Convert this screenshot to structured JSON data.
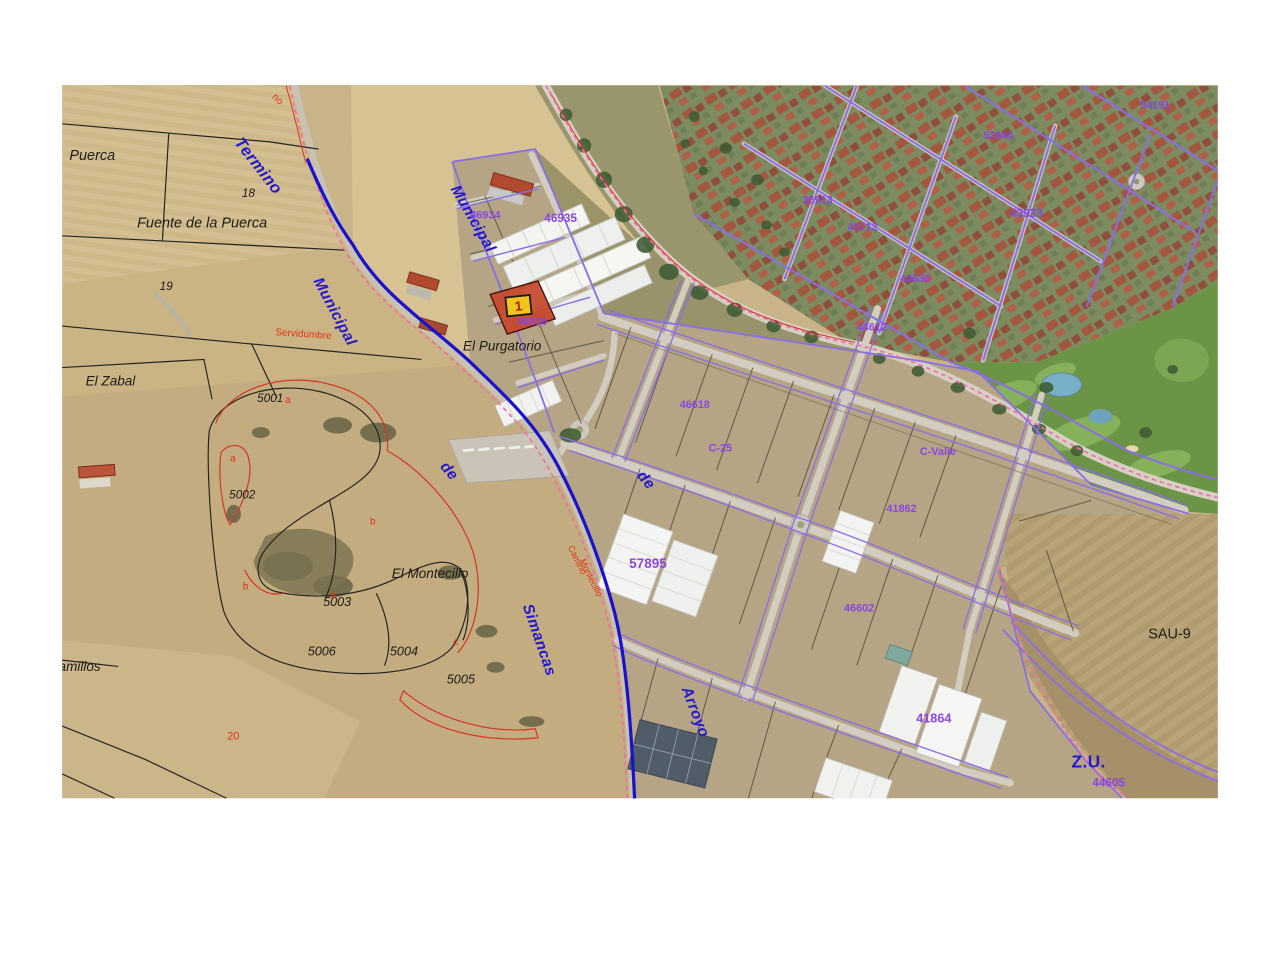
{
  "map_type": "aerial-cadastral-viewer",
  "marker": {
    "label": "1"
  },
  "colors": {
    "municipal_boundary_line": "#1d12cc",
    "cadastral_parcel_line": "#8a6ee6",
    "limit_dashed_line": "#ef6fa0",
    "highlighted_parcel_fill": "#c7462b",
    "marker_background": "#f2c51c",
    "label_black": "#1d1b16",
    "label_blue": "#2317d0",
    "label_red": "#e23318",
    "label_purple": "#8a46e0"
  },
  "labels": [
    {
      "t": "Puerca",
      "c": "black",
      "x": 8,
      "y": 168,
      "r": 0,
      "s": 16,
      "i": 1
    },
    {
      "t": "Fuente de la Puerca",
      "c": "black",
      "x": 83,
      "y": 243,
      "r": 0,
      "s": 16,
      "i": 1
    },
    {
      "t": "18",
      "c": "black",
      "x": 199,
      "y": 209,
      "r": 0,
      "s": 13,
      "i": 1
    },
    {
      "t": "19",
      "c": "black",
      "x": 108,
      "y": 312,
      "r": 0,
      "s": 13,
      "i": 1
    },
    {
      "t": "El Zabal",
      "c": "black",
      "x": 26,
      "y": 418,
      "r": 0,
      "s": 15,
      "i": 1
    },
    {
      "t": "5001",
      "c": "black",
      "x": 216,
      "y": 436,
      "r": 0,
      "s": 13,
      "i": 1
    },
    {
      "t": "5002",
      "c": "black",
      "x": 185,
      "y": 543,
      "r": 0,
      "s": 13,
      "i": 1
    },
    {
      "t": "5003",
      "c": "black",
      "x": 289,
      "y": 662,
      "r": 0,
      "s": 14,
      "i": 1
    },
    {
      "t": "5006",
      "c": "black",
      "x": 272,
      "y": 717,
      "r": 0,
      "s": 14,
      "i": 1
    },
    {
      "t": "5004",
      "c": "black",
      "x": 363,
      "y": 717,
      "r": 0,
      "s": 14,
      "i": 1
    },
    {
      "t": "5005",
      "c": "black",
      "x": 426,
      "y": 748,
      "r": 0,
      "s": 14,
      "i": 1
    },
    {
      "t": "El Purgatorio",
      "c": "black",
      "x": 444,
      "y": 379,
      "r": 0,
      "s": 15,
      "i": 1
    },
    {
      "t": "El Montecillo",
      "c": "black",
      "x": 365,
      "y": 631,
      "r": 0,
      "s": 15,
      "i": 1
    },
    {
      "t": "amillos",
      "c": "black",
      "x": -4,
      "y": 734,
      "r": 0,
      "s": 15,
      "i": 1
    },
    {
      "t": "SAU-9",
      "c": "black",
      "x": 1203,
      "y": 698,
      "r": 0,
      "s": 16
    },
    {
      "t": "Termino",
      "c": "blue",
      "x": 190,
      "y": 149,
      "r": 52,
      "s": 18,
      "b": 1,
      "i": 1
    },
    {
      "t": "Municipal",
      "c": "blue",
      "x": 278,
      "y": 302,
      "r": 62,
      "s": 17,
      "b": 1,
      "i": 1
    },
    {
      "t": "de",
      "c": "blue",
      "x": 418,
      "y": 508,
      "r": 50,
      "s": 17,
      "b": 1,
      "i": 1
    },
    {
      "t": "Simancas",
      "c": "blue",
      "x": 510,
      "y": 662,
      "r": 71,
      "s": 17,
      "b": 1,
      "i": 1
    },
    {
      "t": "Municipal",
      "c": "blue",
      "x": 430,
      "y": 200,
      "r": 60,
      "s": 17,
      "b": 1,
      "i": 1
    },
    {
      "t": "de",
      "c": "blue",
      "x": 636,
      "y": 518,
      "r": 50,
      "s": 17,
      "b": 1,
      "i": 1
    },
    {
      "t": "Arroyo",
      "c": "blue",
      "x": 686,
      "y": 754,
      "r": 69,
      "s": 17,
      "b": 1,
      "i": 1
    },
    {
      "t": "Z.U.",
      "c": "blue",
      "x": 1118,
      "y": 841,
      "r": 0,
      "s": 19,
      "b": 1
    },
    {
      "t": "no",
      "c": "red",
      "x": 232,
      "y": 99,
      "r": 42,
      "s": 11
    },
    {
      "t": "Servidumbre",
      "c": "red",
      "x": 236,
      "y": 362,
      "r": 4,
      "s": 11
    },
    {
      "t": "a",
      "c": "red",
      "x": 247,
      "y": 437,
      "r": 0,
      "s": 11
    },
    {
      "t": "a",
      "c": "red",
      "x": 186,
      "y": 502,
      "r": 0,
      "s": 11
    },
    {
      "t": "b",
      "c": "red",
      "x": 341,
      "y": 572,
      "r": 0,
      "s": 11
    },
    {
      "t": "b",
      "c": "red",
      "x": 200,
      "y": 644,
      "r": 0,
      "s": 11
    },
    {
      "t": "a",
      "c": "red",
      "x": 297,
      "y": 653,
      "r": 0,
      "s": 11
    },
    {
      "t": "c",
      "c": "red",
      "x": 433,
      "y": 705,
      "r": 0,
      "s": 11
    },
    {
      "t": "20",
      "c": "red",
      "x": 183,
      "y": 810,
      "r": 0,
      "s": 12
    },
    {
      "t": "Camino",
      "c": "red",
      "x": 560,
      "y": 597,
      "r": 64,
      "s": 10
    },
    {
      "t": "Montecillo",
      "c": "red",
      "x": 573,
      "y": 612,
      "r": 64,
      "s": 10
    },
    {
      "t": "46935",
      "c": "purple",
      "x": 534,
      "y": 237,
      "r": 0,
      "s": 13,
      "b": 1
    },
    {
      "t": "46936",
      "c": "purple",
      "x": 504,
      "y": 351,
      "r": 0,
      "s": 12,
      "b": 1
    },
    {
      "t": "46934",
      "c": "purple",
      "x": 452,
      "y": 233,
      "r": 0,
      "s": 12,
      "b": 1
    },
    {
      "t": "46618",
      "c": "purple",
      "x": 684,
      "y": 443,
      "r": 0,
      "s": 12,
      "b": 1
    },
    {
      "t": "C-25",
      "c": "purple",
      "x": 716,
      "y": 491,
      "r": 0,
      "s": 12,
      "b": 1
    },
    {
      "t": "C-Valle",
      "c": "purple",
      "x": 950,
      "y": 495,
      "r": 0,
      "s": 12,
      "b": 1
    },
    {
      "t": "57895",
      "c": "purple",
      "x": 628,
      "y": 620,
      "r": 0,
      "s": 15,
      "b": 1
    },
    {
      "t": "41862",
      "c": "purple",
      "x": 913,
      "y": 558,
      "r": 0,
      "s": 12,
      "b": 1
    },
    {
      "t": "46602",
      "c": "purple",
      "x": 866,
      "y": 668,
      "r": 0,
      "s": 12,
      "b": 1
    },
    {
      "t": "41864",
      "c": "purple",
      "x": 946,
      "y": 791,
      "r": 0,
      "s": 14,
      "b": 1
    },
    {
      "t": "44605",
      "c": "purple",
      "x": 1141,
      "y": 862,
      "r": 0,
      "s": 13,
      "b": 1
    },
    {
      "t": "36913",
      "c": "purple",
      "x": 820,
      "y": 216,
      "r": 0,
      "s": 12,
      "b": 1
    },
    {
      "t": "43712",
      "c": "purple",
      "x": 870,
      "y": 246,
      "r": 0,
      "s": 12,
      "b": 1
    },
    {
      "t": "43639",
      "c": "purple",
      "x": 928,
      "y": 303,
      "r": 0,
      "s": 12,
      "b": 1
    },
    {
      "t": "44612",
      "c": "purple",
      "x": 880,
      "y": 357,
      "r": 0,
      "s": 12,
      "b": 1
    },
    {
      "t": "52944",
      "c": "purple",
      "x": 1020,
      "y": 145,
      "r": 0,
      "s": 12,
      "b": 1
    },
    {
      "t": "43933",
      "c": "purple",
      "x": 1050,
      "y": 231,
      "r": 0,
      "s": 13,
      "b": 1
    },
    {
      "t": "54191",
      "c": "purple",
      "x": 1194,
      "y": 111,
      "r": 0,
      "s": 12,
      "b": 1
    }
  ]
}
